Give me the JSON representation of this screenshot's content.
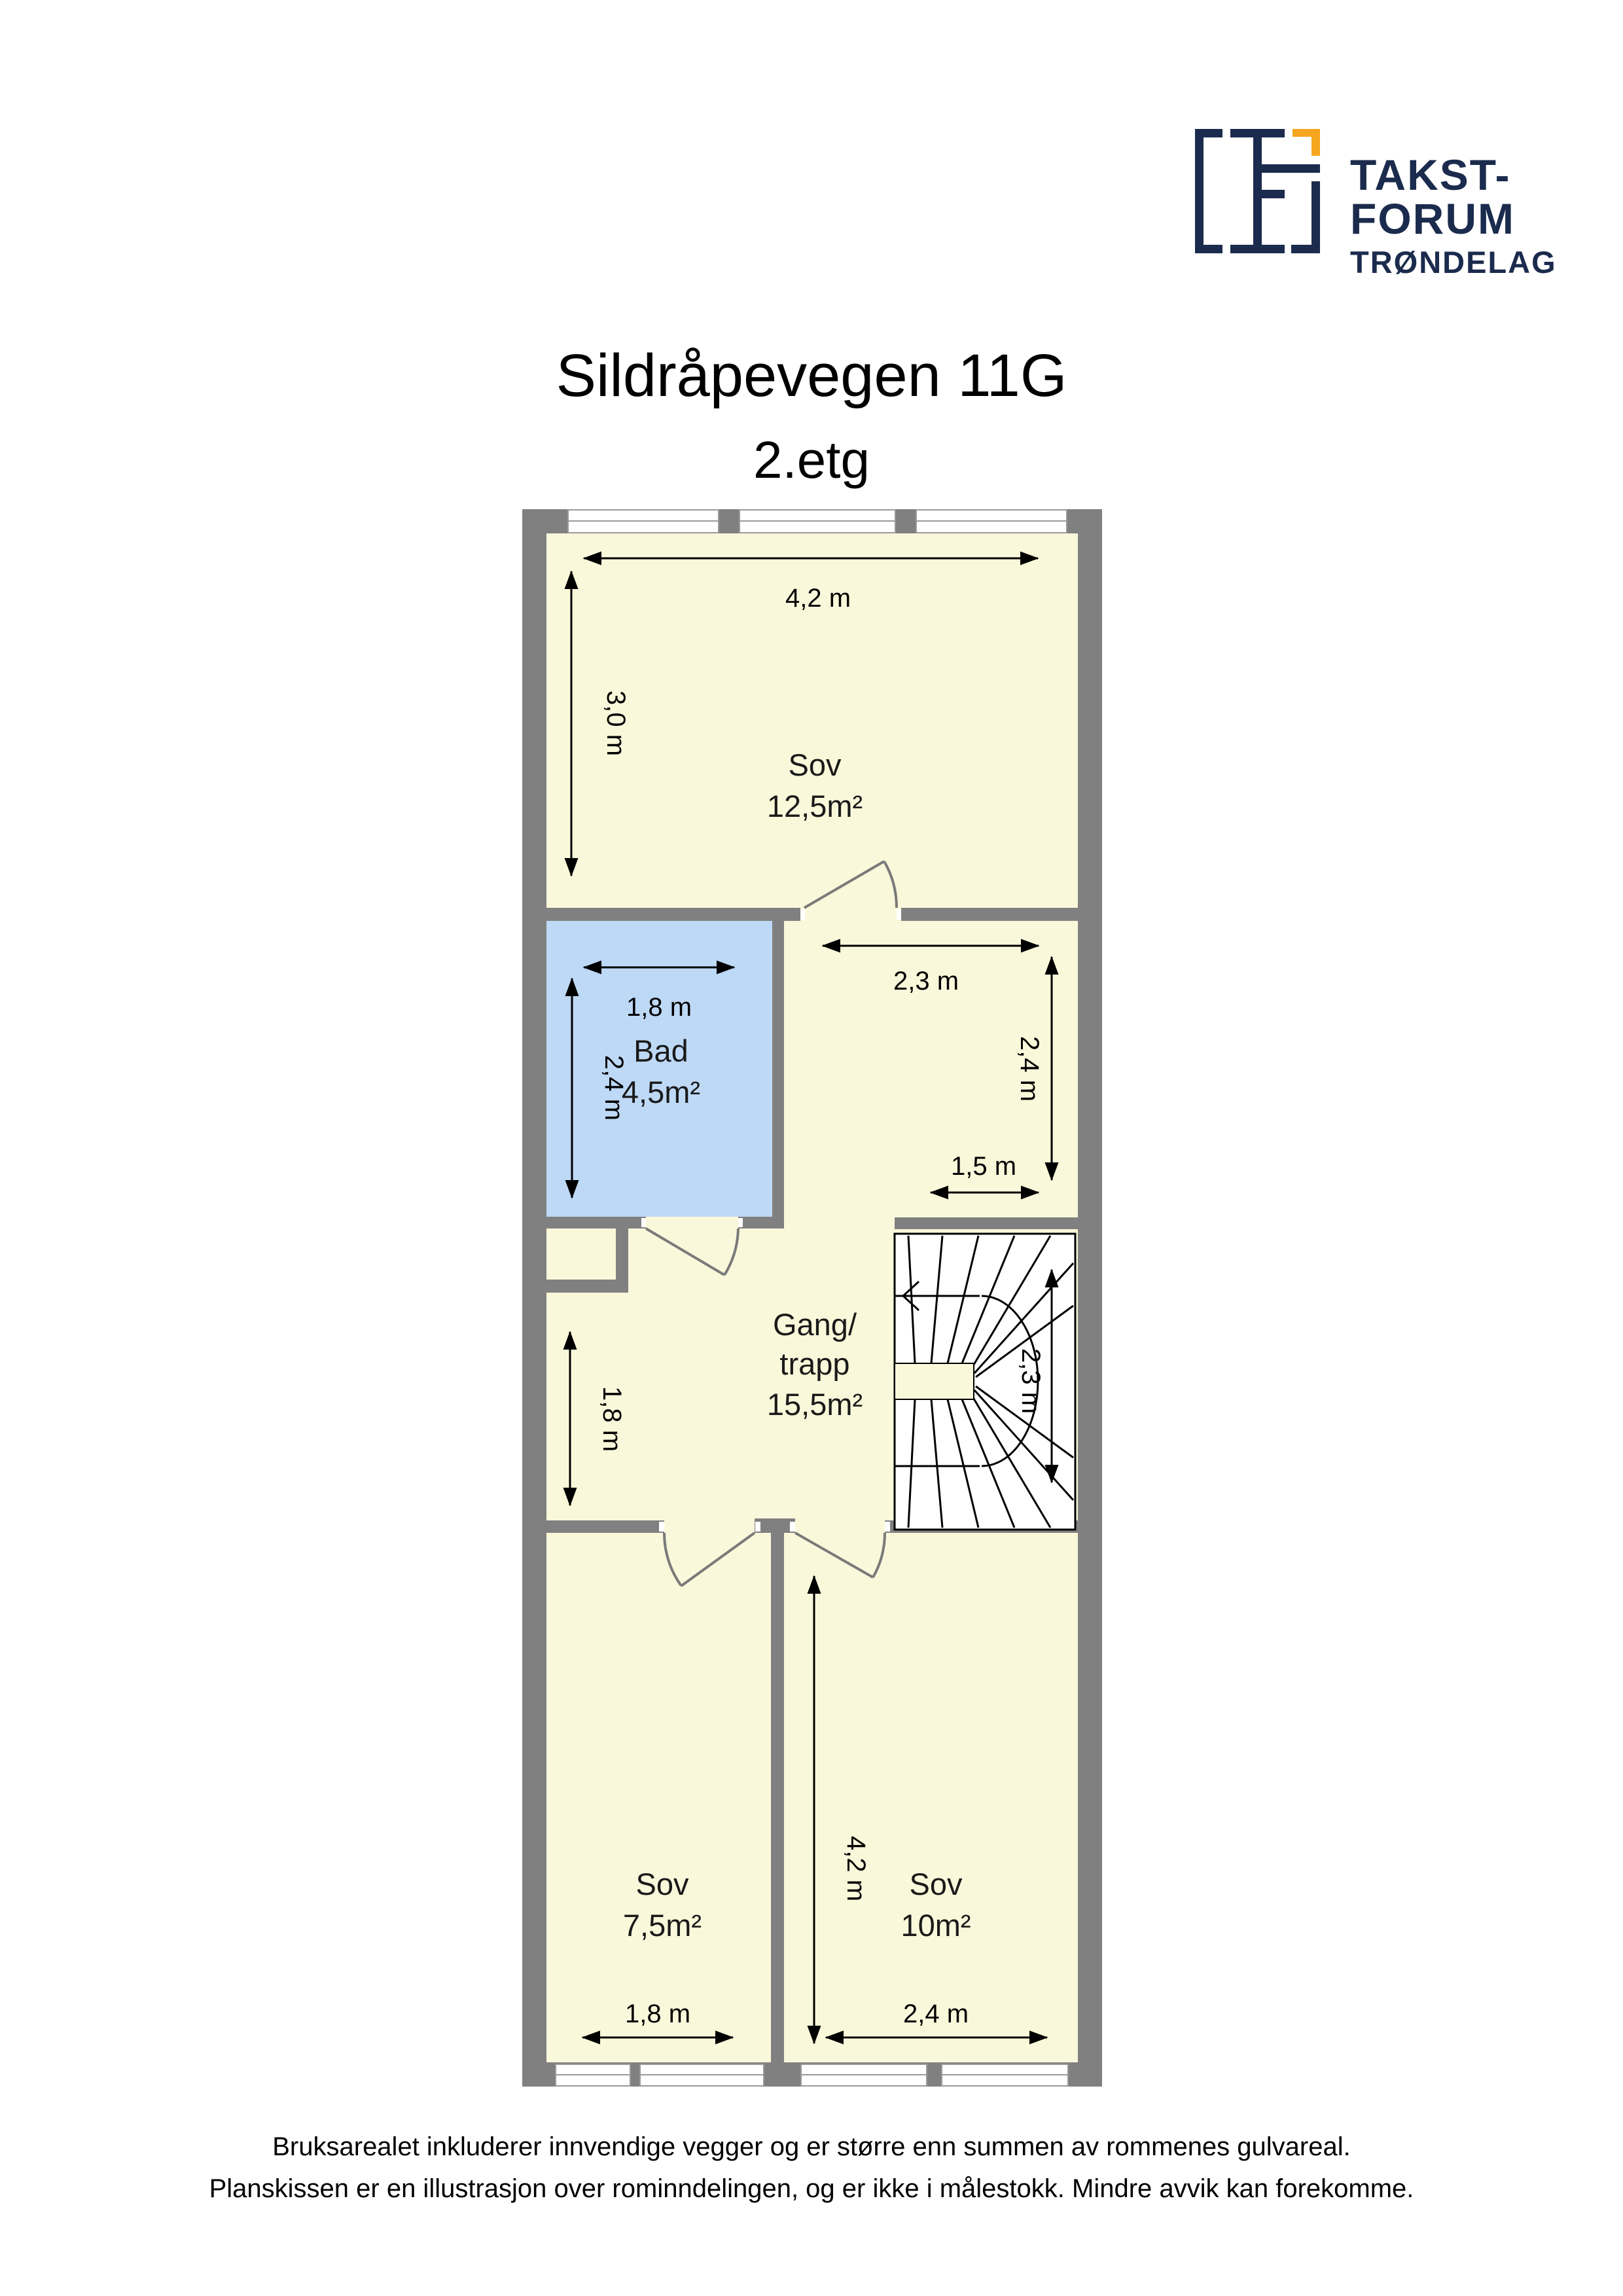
{
  "logo": {
    "line1": "TAKST-",
    "line2": "FORUM",
    "line3": "TRØNDELAG"
  },
  "header": {
    "title": "Sildråpevegen 11G",
    "subtitle": "2.etg"
  },
  "rooms": {
    "sov_top": {
      "name": "Sov",
      "area": "12,5m²"
    },
    "bad": {
      "name": "Bad",
      "area": "4,5m²"
    },
    "gang": {
      "name_line1": "Gang/",
      "name_line2": "trapp",
      "area": "15,5m²"
    },
    "sov_left": {
      "name": "Sov",
      "area": "7,5m²"
    },
    "sov_right": {
      "name": "Sov",
      "area": "10m²"
    }
  },
  "dimensions": {
    "sov_top_width": "4,2 m",
    "sov_top_height": "3,0 m",
    "bad_width": "1,8 m",
    "bad_height": "2,4 m",
    "gang_upper_width": "2,3 m",
    "gang_upper_height": "2,4 m",
    "gang_opening": "1,5 m",
    "gang_lower_height": "1,8 m",
    "stairs_height": "2,3 m",
    "sov_right_height": "4,2 m",
    "sov_left_width": "1,8 m",
    "sov_right_width": "2,4 m"
  },
  "footer": {
    "line1": "Bruksarealet inkluderer innvendige vegger og er større enn summen av rommenes gulvareal.",
    "line2": "Planskissen er en illustrasjon over rominndelingen, og er ikke i målestokk. Mindre avvik kan forekomme."
  },
  "colors": {
    "wall": "#808080",
    "room_fill": "#FAF8DA",
    "bathroom_fill": "#BED9F6",
    "stairs_fill": "#FFFFFF",
    "logo_navy": "#1B2B4D",
    "logo_orange": "#F6A51E"
  }
}
